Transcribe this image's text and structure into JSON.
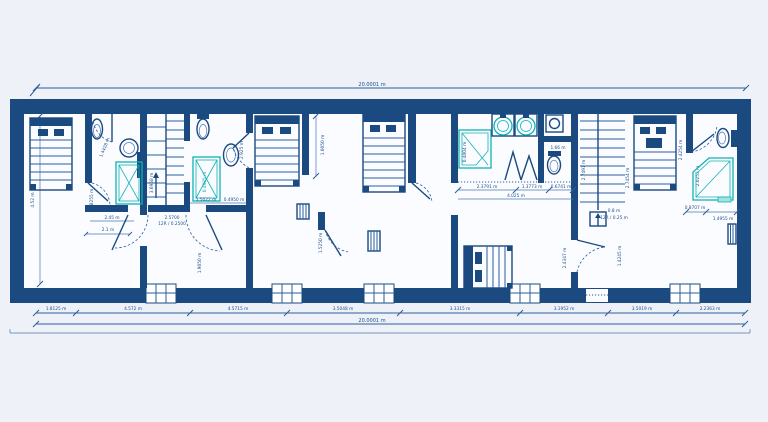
{
  "drawing": {
    "type": "architectural floor plan",
    "top_total": "20.0001 m",
    "bottom_total": "20.0001 m",
    "left_height": "4.52 m",
    "bottom_segments": [
      "1.8125 m",
      "4.572 m",
      "4.5715 m",
      "3.5048 m",
      "3.3315 m",
      "3.1952 m",
      "3.5019 m",
      "2.2363 m"
    ],
    "labels": {
      "bath1_door": "1.4428 m",
      "bed1_door": "0.8255 m",
      "bath1_width": "2.45 m",
      "bath1_clear": "2.1 m",
      "stair1_run": "3.6958 m",
      "stair1_tread": "2.5700",
      "stair1_risers": "12R / 0.2500",
      "tub2_width": "0.4985 m",
      "tub2_length": "1.5022 m",
      "tub2_offset": "0.4950 m",
      "hall_door_left": "1.1750 m",
      "hall_door_mid": "1.9050 m",
      "bath2_height": "2.925 m",
      "niche_width": "1.0050 m",
      "hall_door_right": "1.5250 m",
      "bath3_seg1": "2.3791 m",
      "bath3_seg2": "1.3773 m",
      "bath3_seg3": "0.6741 m",
      "bath3_total": "4.025 m",
      "shower3_width": "0.4004 m",
      "wc3_depth": "1.66 m",
      "stair2_left": "2.7491 m",
      "stair2_right": "2.7454 m",
      "stair2_area": "0.8 m",
      "stair2_risers": "12R / 0.25 m",
      "bed5_side": "2.4347 m",
      "door_right": "1.4245 m",
      "bed4_side": "2.4254 m",
      "bath4_height": "2.0253 m",
      "bath4_seg1": "0.8707 m",
      "bath4_seg2": "1.4955 m"
    }
  },
  "colors": {
    "wall": "#1a4a80",
    "line": "#2a5e9b",
    "fixture_teal": "#0fb3b4",
    "background": "#eef1f8",
    "floor": "#fbfcff"
  }
}
